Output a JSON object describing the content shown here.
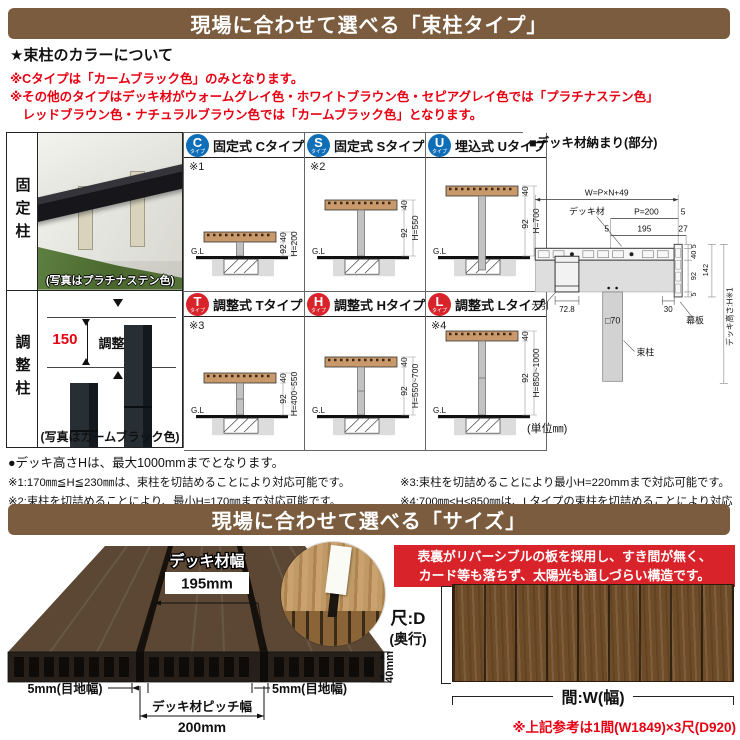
{
  "banners": {
    "tsukabashira": "現場に合わせて選べる「束柱タイプ」",
    "size": "現場に合わせて選べる「サイズ」"
  },
  "colors": {
    "banner_brown": "#7b5c3e",
    "note_red": "#e60012",
    "badge_blue": "#0e6eb8",
    "badge_red": "#d8232a",
    "red_box": "#d8232a",
    "deck_wood": "#c9996b",
    "plan_wood": "#6f4c28"
  },
  "color_note": {
    "heading": "★束柱のカラーについて",
    "line1": "※Cタイプは「カームブラック色」のみとなります。",
    "line2": "※その他のタイプはデッキ材がウォームグレイ色・ホワイトブラウン色・セピアグレイ色では「プラチナステン色」",
    "line3": "　レッドブラウン色・ナチュラルブラウン色では「カームブラック色」となります。"
  },
  "left_panel": {
    "fixed_label": "固定柱",
    "fixed_caption": "(写真はプラチナステン色)",
    "adjust_label": "調整柱",
    "adjust_value": "150",
    "adjust_word": "調整",
    "adjust_caption": "(写真はカームブラック色)"
  },
  "gl": "G.L",
  "types": [
    {
      "badge": "C",
      "badge_sub": "タイプ",
      "title": "固定式 Cタイプ",
      "note": "※1",
      "d40": "40",
      "d92": "92",
      "h": "H=200"
    },
    {
      "badge": "S",
      "badge_sub": "タイプ",
      "title": "固定式 Sタイプ",
      "note": "※2",
      "d40": "40",
      "d92": "92",
      "h": "H=550"
    },
    {
      "badge": "U",
      "badge_sub": "タイプ",
      "title": "埋込式 Uタイプ",
      "note": "",
      "d40": "40",
      "d92": "92",
      "h": "H=700"
    },
    {
      "badge": "T",
      "badge_sub": "タイプ",
      "title": "調整式 Tタイプ",
      "note": "※3",
      "d40": "40",
      "d92": "92",
      "h": "H=400~550"
    },
    {
      "badge": "H",
      "badge_sub": "タイプ",
      "title": "調整式 Hタイプ",
      "note": "",
      "d40": "40",
      "d92": "92",
      "h": "H=550~700"
    },
    {
      "badge": "L",
      "badge_sub": "タイプ",
      "title": "調整式 Lタイプ",
      "note": "※4",
      "d40": "40",
      "d92": "92",
      "h": "H=850~1000"
    }
  ],
  "detail": {
    "title": "■デッキ材納まり(部分)",
    "w_formula": "W=P×N+49",
    "deck_label": "デッキ材",
    "p": "P=200",
    "g5": "5",
    "n195": "195",
    "n27": "27",
    "row5": "5",
    "r5a": "5",
    "r40": "40",
    "r92": "92",
    "r5b": "5",
    "r142": "142",
    "obiki": "大引",
    "n728": "72.8",
    "n30": "30",
    "post_size": "□70",
    "makiita": "幕板",
    "tsuka": "束柱",
    "deck_h": "デッキ高さ:H※1",
    "unit": "(単位㎜)"
  },
  "notes": {
    "bullet": "●デッキ高さHは、最大1000mmまでとなります。",
    "n1": "※1:170㎜≦H≦230㎜は、束柱を切詰めることにより対応可能です。",
    "n2": "※2:束柱を切詰めることにより、最小H=170㎜まで対応可能です。",
    "n3": "※3:束柱を切詰めることにより最小H=220mmまで対応可能です。",
    "n4": "※4:700㎜<H<850㎜は、Lタイプの束柱を切詰めることにより対応可能です。"
  },
  "size": {
    "deck_width_label": "デッキ材幅",
    "deck_width_value": "195mm",
    "gap_left": "5mm(目地幅)",
    "gap_right": "5mm(目地幅)",
    "pitch_label": "デッキ材ピッチ幅",
    "pitch_value": "200mm",
    "thickness": "40mm",
    "box_line1": "表裏がリバーシブルの板を採用し、すき間が無く、",
    "box_line2": "カード等も落ちず、太陽光も通しづらい構造です。",
    "depth_label": "尺:D",
    "depth_sub": "(奥行)",
    "width_label": "間:W(幅)",
    "ref_note": "※上記参考は1間(W1849)×3尺(D920)"
  }
}
